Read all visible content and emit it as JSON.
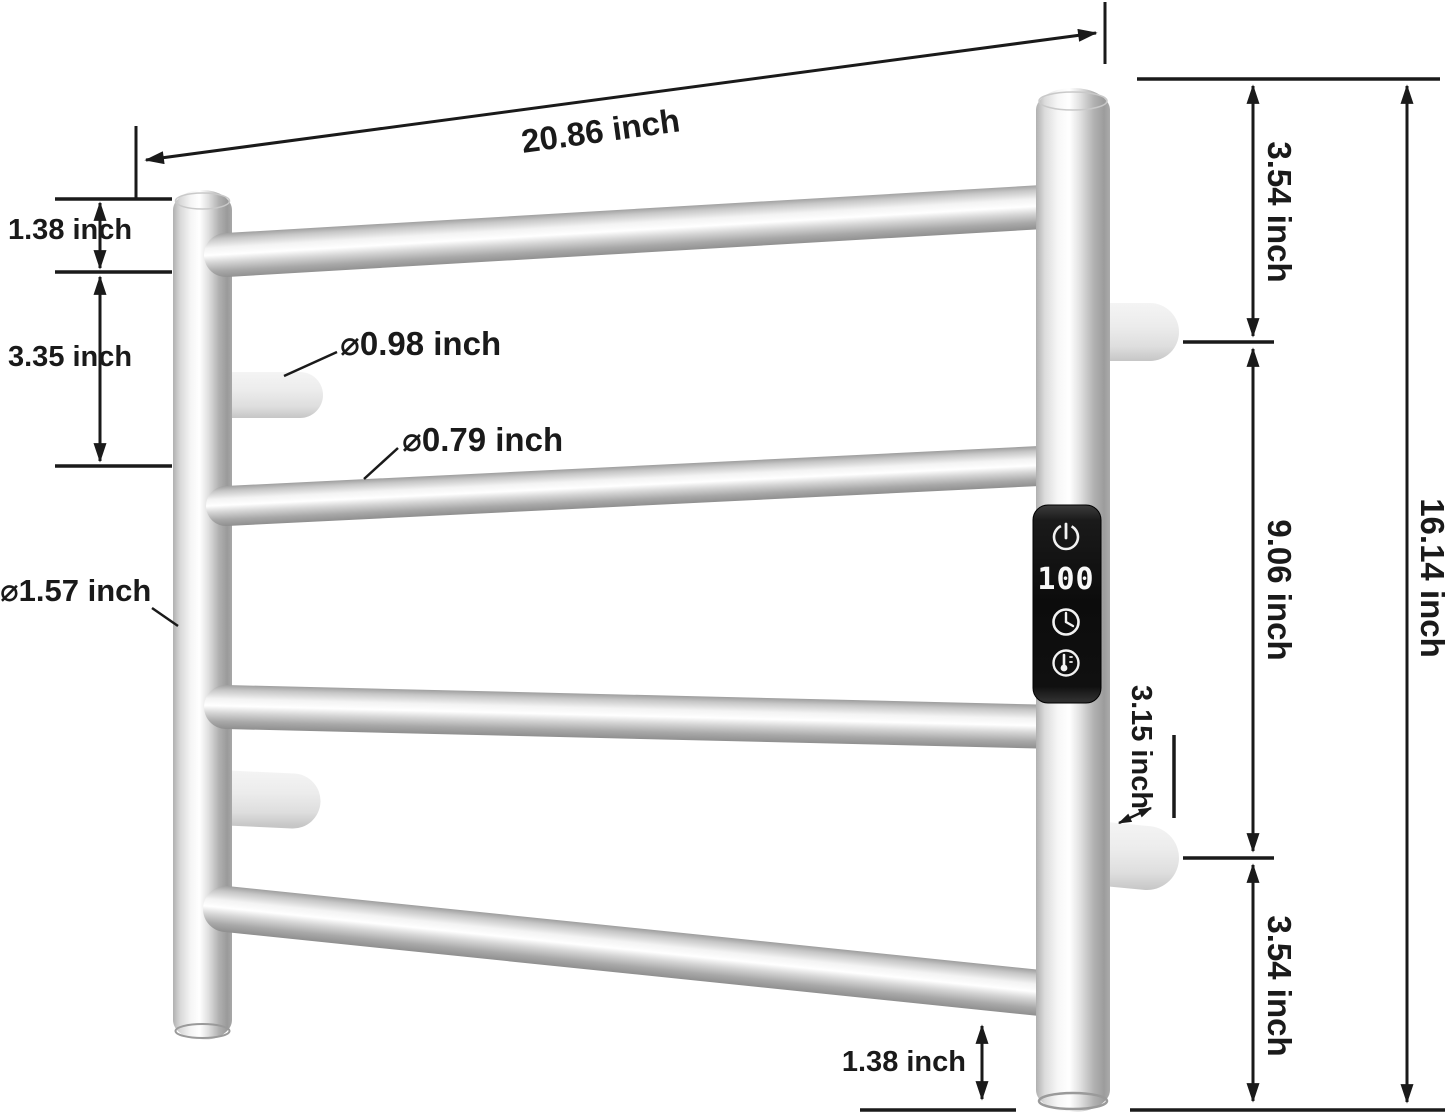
{
  "diagram": {
    "background": "#ffffff",
    "dimensions": {
      "top_width": {
        "label": "20.86 inch"
      },
      "left_top_gap": {
        "label": "1.38 inch"
      },
      "left_bar_spacing": {
        "label": "3.35 inch"
      },
      "top_peg_diameter": {
        "label": "⌀0.98 inch"
      },
      "bar_diameter": {
        "label": "⌀0.79 inch"
      },
      "post_diameter": {
        "label": "⌀1.57 inch"
      },
      "right_top_gap": {
        "label": "3.54 inch"
      },
      "right_mid_span": {
        "label": "9.06 inch"
      },
      "total_height": {
        "label": "16.14 inch"
      },
      "peg_length": {
        "label": "3.15 inch"
      },
      "right_bottom_gap": {
        "label": "3.54 inch"
      },
      "bottom_gap": {
        "label": "1.38 inch"
      }
    },
    "control_panel": {
      "display_value": "100",
      "icons": [
        {
          "name": "power-icon"
        },
        {
          "name": "clock-icon"
        },
        {
          "name": "thermometer-icon"
        }
      ]
    },
    "colors": {
      "annotation": "#1a1a1a",
      "metal_highlight": "#ffffff",
      "metal_mid": "#d8d8d8",
      "metal_shadow": "#8f8f8f",
      "peg_fill": "#e9e9e9",
      "panel_black": "#111111",
      "led_white": "#f8f8f8"
    }
  }
}
